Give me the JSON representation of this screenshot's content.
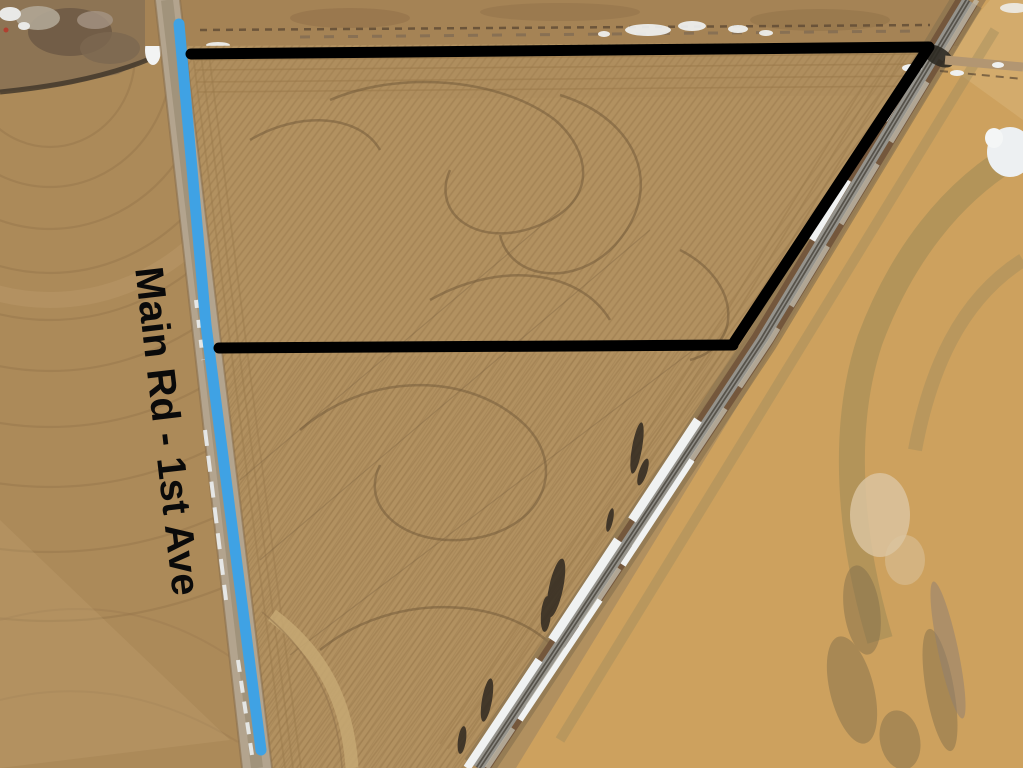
{
  "annotations": {
    "road_label": {
      "text": "Main Rd - 1st Ave",
      "color": "#0a0a0a"
    },
    "road_highlight": {
      "color": "#3fa2e4",
      "width": "11",
      "points": "179,24 206,325 261,750"
    },
    "parcel_boundary": {
      "color": "#000000",
      "width": "11",
      "top_and_east_points": "191,54 929,47 733,344",
      "south_points": "733,345 219,348"
    }
  }
}
